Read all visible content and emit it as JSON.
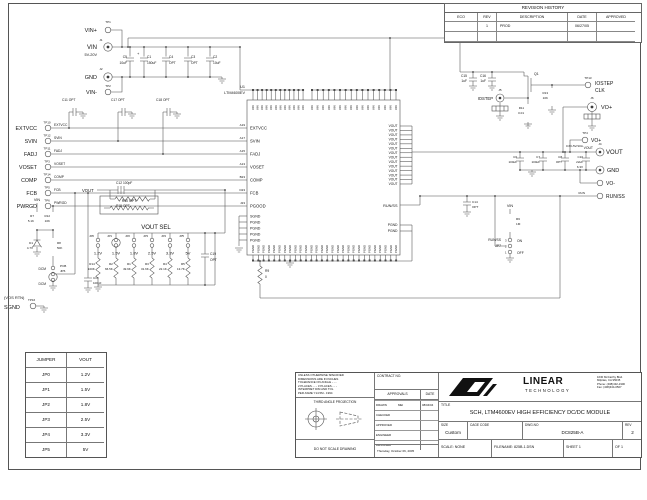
{
  "revision_history": {
    "title": "REVISION HISTORY",
    "headers": [
      "ECO",
      "REV",
      "DESCRIPTION",
      "DATE",
      "APPROVED"
    ],
    "rows": [
      [
        "",
        "1",
        "PROD",
        "06/27/05",
        ""
      ],
      [
        "",
        "",
        "",
        "",
        ""
      ]
    ]
  },
  "jumper_table": {
    "headers": [
      "JUMPER",
      "VOUT"
    ],
    "rows": [
      [
        "JP0",
        "1.2V"
      ],
      [
        "JP1",
        "1.5V"
      ],
      [
        "JP2",
        "1.8V"
      ],
      [
        "JP3",
        "2.5V"
      ],
      [
        "JP4",
        "3.3V"
      ],
      [
        "JP5",
        "5V"
      ]
    ]
  },
  "title_block": {
    "spec_lines": [
      "UNLESS OTHERWISE SPECIFIED",
      "DIMENSIONS ARE IN INCHES",
      "TOLERANCE ON ANGLE - - -",
      "2 PLACES - - -   3 PLACES - - -",
      "INTERPRET DIM AND TOL",
      "PER ASME Y14.5M - 1994"
    ],
    "third_angle": "THIRD ANGLE PROJECTION",
    "do_not_scale": "DO NOT SCALE DRAWING",
    "contract_label": "CONTRACT NO.",
    "approvals_label": "APPROVALS",
    "date_label": "DATE",
    "approval_rows": [
      [
        "DRAWN",
        "MEI",
        "08/04/04"
      ],
      [
        "CHECKED",
        "",
        ""
      ],
      [
        "APPROVED",
        "",
        ""
      ],
      [
        "ENGINEER",
        "",
        ""
      ],
      [
        "DESIGNER",
        "",
        ""
      ]
    ],
    "print_date": "Thursday, October 06, 2005",
    "company": {
      "name_top": "LINEAR",
      "name_bottom": "TECHNOLOGY",
      "address_lines": [
        "1630 McCarthy Blvd.",
        "Milpitas, CA 95035",
        "Phone: (408)432-1900",
        "Fax: (408)434-0507"
      ]
    },
    "title_label": "TITLE",
    "title": "SCH, LTM4600EV HIGH EFFICIENCY DC/DC MODULE",
    "size_label": "SIZE",
    "size_value": "Custom",
    "cage_label": "CAGE CODE",
    "dwg_label": "DWG.NO",
    "dwg_no": "DC825B-A",
    "rev_label": "REV",
    "rev_value": "2",
    "scale_label": "SCALE: NONE",
    "filename_label": "FILENAME:",
    "filename_value": "825B-1.DSN",
    "sheet_label": "SHEET",
    "sheet_value": "1",
    "of_label": "OF",
    "of_value": "1"
  },
  "connectors": {
    "tp1": {
      "ref": "TP1",
      "label": "VIN+"
    },
    "j1": {
      "ref": "J1",
      "label": "VIN",
      "sub": "5V-20V"
    },
    "j2": {
      "ref": "J2",
      "label": "GND"
    },
    "tp2": {
      "ref": "TP2",
      "label": "VIN-"
    }
  },
  "schematic": {
    "input": {
      "c1": "C1",
      "c1v": "150uF",
      "plus": "+",
      "c4": "C4",
      "c4v": "OPT",
      "c3": "C3",
      "c3v": "OPT",
      "c2": "C2",
      "c2v": "10uF",
      "c5": "C5",
      "c5v": "10uF"
    },
    "bypass": {
      "c11": "C11 OPT",
      "c17": "C17 OPT",
      "c18": "C18 OPT"
    },
    "signals": {
      "rows": [
        {
          "label": "EXTVCC",
          "tp": "TP10",
          "net": "EXTVCC",
          "pin": "A19",
          "pin_name": "EXTVCC"
        },
        {
          "label": "SVIN",
          "tp": "TP12",
          "net": "SVIN",
          "pin": "A17",
          "pin_name": "SVIN"
        },
        {
          "label": "FADJ",
          "tp": "TP11",
          "net": "FADJ",
          "pin": "A15",
          "pin_name": "FADJ"
        },
        {
          "label": "VOSET",
          "tp": "TP3",
          "net": "VOSET",
          "pin": "A13",
          "pin_name": "VOSET"
        },
        {
          "label": "COMP",
          "tp": "TP14",
          "net": "COMP",
          "pin": "B23",
          "pin_name": "COMP"
        },
        {
          "label": "FCB",
          "tp": "TP5",
          "net": "FCB",
          "pin": "D23",
          "pin_name": "FCB"
        },
        {
          "label": "PWRGD",
          "tp": "TP6",
          "net": "PWRGD",
          "pin": "J23",
          "pin_name": "PGOOD"
        }
      ]
    },
    "feedback": {
      "vout_net": "VOUT",
      "c12": "C12 100pF",
      "r15": "R15 OPT"
    },
    "pwrgd_net": {
      "vin": "VIN",
      "r7": "R7",
      "r7v": "5.1K",
      "r12": "R12",
      "r12v": "10K",
      "d1": "D1",
      "d1v": "4.7V",
      "r8": "R8",
      "r8v": "50K",
      "pcb": "PCB",
      "jp6": "JP6",
      "dcm_top": "DCM",
      "dcm_bot": "DCM",
      "c13": "C13",
      "c13v": "100pF"
    },
    "sgnd": {
      "vos_rtn": "(VOS RTN)",
      "label": "SGND",
      "tp": "TP16"
    },
    "vout_sel": {
      "title": "VOUT SEL",
      "r10": "R10 OPT",
      "c19": "C19",
      "c19v": "OPT",
      "columns": [
        {
          "jp": "JP0",
          "v": "1.2V",
          "r": "R14",
          "rv": "100K"
        },
        {
          "jp": "JP1",
          "v": "1.5V",
          "r": "R2",
          "rv": "66.5K"
        },
        {
          "jp": "JP2",
          "v": "1.8V",
          "r": "R1",
          "rv": "49.9K"
        },
        {
          "jp": "JP3",
          "v": "2.5V",
          "r": "R3",
          "rv": "31.6K"
        },
        {
          "jp": "JP4",
          "v": "3.3V",
          "r": "R4",
          "rv": "22.1K"
        },
        {
          "jp": "JP5",
          "v": "5V",
          "r": "R5",
          "rv": "13.7K"
        }
      ]
    },
    "ic": {
      "ref": "U1",
      "part": "LTM4600EV",
      "run_ss": "RUN/SS",
      "r9": "R9",
      "r9v": "0",
      "left_bottom_pins": [
        "SGND",
        "PGND",
        "PGND",
        "PGND",
        "PGND"
      ],
      "right_pgnd": [
        "PGND",
        "PGND"
      ],
      "top_pin_name": "VIN",
      "bottom_pin_name": "PGND",
      "right_vout_name": "VOUT",
      "right_vout_count": 14,
      "top_left_count": 12,
      "top_right_count": 16,
      "bottom_count": 28
    },
    "right": {
      "c15": "C15",
      "c15v": "1uF",
      "c16": "C16",
      "c16v": "1uF",
      "q1": "Q1",
      "r11": "R11",
      "r11v": "0.01",
      "j5": "J5",
      "iostep": "IOSTEP",
      "r13": "R13",
      "r13v": "10K",
      "tp13": "TP13",
      "clk1": "IOSTEP",
      "clk2": "CLK",
      "j6": "J6",
      "vo_plus": "VO+",
      "tp4": "TP4",
      "tp4_label": "VO+",
      "vout_net": "VOUT",
      "j4": "J4",
      "vout_label": "VOUT",
      "rating": "0.6V-5V/10A",
      "c10": "C10",
      "c10v": "22uF",
      "c10v2": "6.3V",
      "c6": "C6",
      "c6v": "100uF",
      "c7": "C7",
      "c7v": "100uF",
      "c8": "C8",
      "c8v": "OPT",
      "gnd": "GND",
      "vo_minus": "VO-",
      "run_net": "RUN",
      "run_ss": "RUN/SS",
      "c14": "C14",
      "c14v": "OPT",
      "vin": "VIN",
      "r6": "R6",
      "r6v": "1M",
      "jp7_label": "RUN/SS",
      "jp7": "JP7",
      "on": "ON",
      "off": "OFF",
      "p3": "3",
      "p2": "2",
      "p1": "1"
    }
  }
}
